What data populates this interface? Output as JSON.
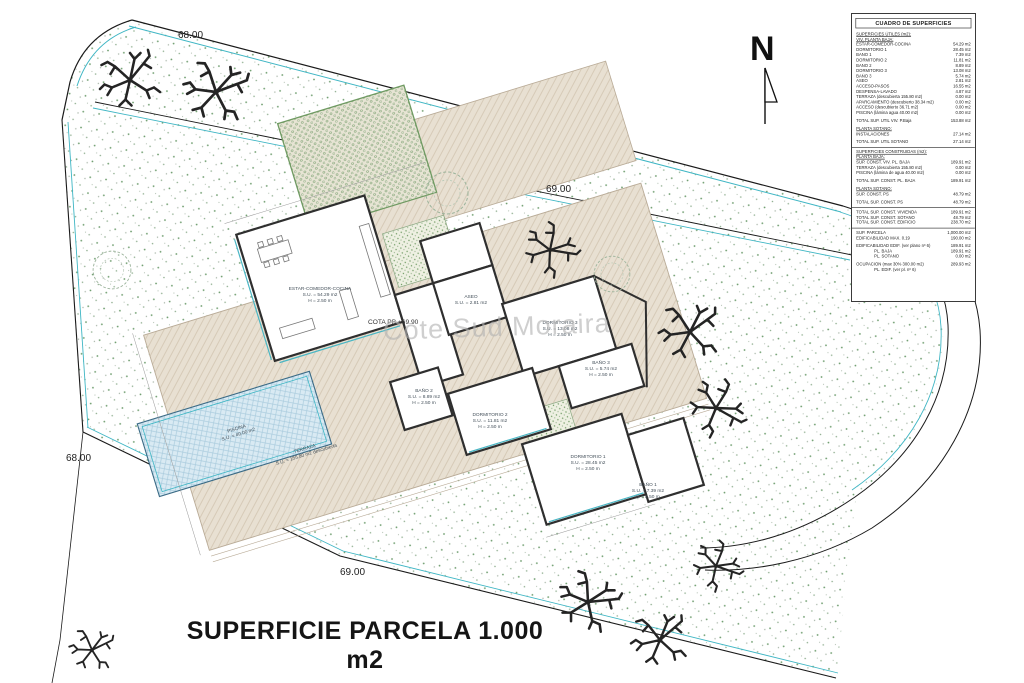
{
  "plan": {
    "title": "SUPERFICIE PARCELA 1.000 m2",
    "watermark": "Cote Sud Moraira",
    "north_label": "N",
    "cota_label": "COTA PB +69.90",
    "contour_labels": {
      "top": "68.00",
      "upper": "69.00",
      "left": "68.00",
      "bottom": "69.00"
    }
  },
  "rooms": [
    {
      "name": "ESTAR-COMEDOR-COCINA",
      "su": "S.U. = 54.29 m2",
      "h": "H = 2.50 m"
    },
    {
      "name": "ASEO",
      "su": "S.U. = 2.81 m2",
      "h": ""
    },
    {
      "name": "DORMITORIO 3",
      "su": "S.U. = 13.08 m2",
      "h": "H = 2.50 m"
    },
    {
      "name": "BAÑO 3",
      "su": "S.U. = 5.74 m2",
      "h": "H = 2.50 m"
    },
    {
      "name": "BAÑO 2",
      "su": "S.U. = 8.89 m2",
      "h": "H = 2.50 m"
    },
    {
      "name": "DORMITORIO 2",
      "su": "S.U. = 11.81 m2",
      "h": "H = 2.50 m"
    },
    {
      "name": "DORMITORIO 1",
      "su": "S.U. = 28.45 m2",
      "h": "H = 2.50 m"
    },
    {
      "name": "BAÑO 1",
      "su": "S.U. = 7.39 m2",
      "h": "H = 2.50 m"
    },
    {
      "name": "PISCINA",
      "su": "S.U. = 40.00 m2",
      "h": ""
    },
    {
      "name": "TERRAZA",
      "su": "S.U. = 155.80 m2 descubierta",
      "h": ""
    }
  ],
  "table": {
    "title": "CUADRO DE SUPERFICIES",
    "sections": [
      {
        "heavy": false,
        "rows": [
          {
            "label": "SUPERFICIES ÚTILES (m2):",
            "value": "",
            "style": "u"
          },
          {
            "label": "VIV. PLANTA BAJA:",
            "value": "",
            "style": "u"
          },
          {
            "label": "ESTAR-COMEDOR-COCINA",
            "value": "54.29 m2"
          },
          {
            "label": "DORMITORIO 1",
            "value": "28.45 m2"
          },
          {
            "label": "BAÑO 1",
            "value": "7.39 m2"
          },
          {
            "label": "DORMITORIO 2",
            "value": "11.81 m2"
          },
          {
            "label": "BAÑO 2",
            "value": "8.89 m2"
          },
          {
            "label": "DORMITORIO 3",
            "value": "13.08 m2"
          },
          {
            "label": "BAÑO 3",
            "value": "5.74 m2"
          },
          {
            "label": "ASEO",
            "value": "2.81 m2"
          },
          {
            "label": "ACCESO-PASOS",
            "value": "16.55 m2"
          },
          {
            "label": "DESPENSA-LAVADO",
            "value": "4.87 m2"
          },
          {
            "label": "TERRAZA (descubierta 155.80 m2)",
            "value": "0.00 m2"
          },
          {
            "label": "APARCAMIENTO (descubierto 38.34 m2)",
            "value": "0.00 m2"
          },
          {
            "label": "ACCESO (descubierto 36.71 m2)",
            "value": "0.00 m2"
          },
          {
            "label": "PISCINA (lámina agua 40.00 m2)",
            "value": "0.00 m2"
          },
          {
            "spacer": true
          },
          {
            "label": "TOTAL SUP. ÚTIL VIV. P.Baja",
            "value": "153.88 m2"
          },
          {
            "spacer": true
          },
          {
            "label": "PLANTA SÓTANO:",
            "value": "",
            "style": "u"
          },
          {
            "label": "INSTALACIONES",
            "value": "27.14 m2"
          },
          {
            "spacer": true
          },
          {
            "label": "TOTAL SUP. ÚTIL SÓTANO",
            "value": "27.14 m2"
          }
        ]
      },
      {
        "heavy": true,
        "rows": [
          {
            "label": "SUPERFICIES CONSTRUIDAS (m2):",
            "value": "",
            "style": "u"
          },
          {
            "label": "PLANTA BAJA:",
            "value": "",
            "style": "u"
          },
          {
            "label": "SUP. CONST. VIV. PL. BAJA",
            "value": "189.91 m2"
          },
          {
            "label": "TERRAZA (descubierta 155.80 m2)",
            "value": "0.00 m2"
          },
          {
            "label": "PISCINA (lámina de agua 40.00 m2)",
            "value": "0.00 m2"
          },
          {
            "spacer": true
          },
          {
            "label": "TOTAL SUP. CONST. PL. BAJA",
            "value": "189.91 m2"
          },
          {
            "spacer": true
          },
          {
            "label": "PLANTA SÓTANO:",
            "value": "",
            "style": "u"
          },
          {
            "label": "SUP. CONST. PS",
            "value": "48.79 m2"
          },
          {
            "spacer": true
          },
          {
            "label": "TOTAL SUP. CONST. PS",
            "value": "48.79 m2"
          }
        ]
      },
      {
        "heavy": false,
        "rows": [
          {
            "label": "TOTAL SUP. CONST. VIVIENDA",
            "value": "189.91 m2"
          },
          {
            "label": "TOTAL SUP. CONST. SÓTANO",
            "value": "48.79 m2"
          },
          {
            "label": "TOTAL SUP. CONST. EDIFICIO",
            "value": "238.70 m2"
          }
        ]
      },
      {
        "heavy": true,
        "rows": [
          {
            "label": "SUP. PARCELA",
            "value": "1,000.00 m2"
          },
          {
            "label": "EDIFICABILIDAD MAX. 0.19",
            "value": "190.00 m2"
          },
          {
            "spacer": true
          },
          {
            "label": "EDIFICABILIDAD EDIF. (ver plano nº 6)",
            "value": "189.91 m2"
          },
          {
            "label": "PL. BAJA",
            "value": "189.91 m2",
            "style": "indent"
          },
          {
            "label": "PL. SÓTANO",
            "value": "0.00 m2",
            "style": "indent"
          },
          {
            "spacer": true
          },
          {
            "label": "OCUPACIÓN (max 30% 300.00 m2)",
            "value": "289.93 m2"
          },
          {
            "label": "PL. EDIF. (ver pl. nº 6)",
            "value": "",
            "style": "indent"
          }
        ]
      }
    ]
  },
  "colors": {
    "boundary_cyan": "#3fb6c4",
    "stipple_green": "#6a9a6a",
    "terrace_tan": "#e8e0d2",
    "pool_blue": "#d9eaf3",
    "pergola_green": "#6f9a62",
    "wall_dark": "#2f2f2f",
    "watermark_gray": "#b3b3b3"
  }
}
